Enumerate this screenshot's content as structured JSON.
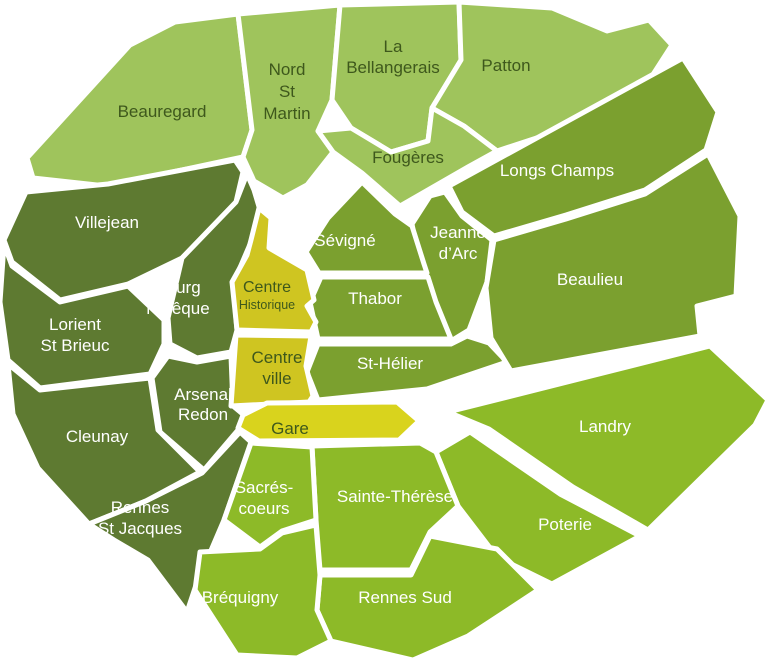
{
  "map": {
    "region_name": "Rennes",
    "background": "#ffffff",
    "palette": {
      "light": "#9fc45c",
      "medium": "#7ba02f",
      "dark": "#5e7a31",
      "bright": "#8dba28",
      "yellow_centre": "#cfc521",
      "yellow_gare": "#d9d31d",
      "boundary": "#ffffff",
      "label_dark": "#3e581c",
      "label_light": "#ffffff"
    },
    "districts": [
      {
        "id": "beauregard",
        "name": "Beauregard",
        "lines": [
          "Beauregard"
        ],
        "shade": "light",
        "label_tone": "dark",
        "points": "130,45 175,22 238,14 252,130 243,157 168,173 106,186 33,178 27,158",
        "label": {
          "x": 162,
          "y": 117,
          "size": 17,
          "line_height": 21
        }
      },
      {
        "id": "nord-st-martin",
        "name": "Nord St Martin",
        "lines": [
          "Nord",
          "St",
          "Martin"
        ],
        "shade": "light",
        "label_tone": "dark",
        "points": "238,14 340,5 332,100 318,131 333,152 307,185 283,198 254,181 243,157 252,130",
        "label": {
          "x": 287,
          "y": 75,
          "size": 17,
          "line_height": 22
        }
      },
      {
        "id": "la-bellangerais",
        "name": "La Bellangerais",
        "lines": [
          "La",
          "Bellangerais"
        ],
        "shade": "light",
        "label_tone": "dark",
        "points": "340,5 459,2 461,60 432,108 428,141 391,152 351,128 332,100",
        "label": {
          "x": 393,
          "y": 52,
          "size": 17,
          "line_height": 21
        }
      },
      {
        "id": "patton",
        "name": "Patton",
        "lines": [
          "Patton"
        ],
        "shade": "light",
        "label_tone": "dark",
        "points": "459,2 552,8 607,31 649,20 672,45 643,90 558,131 497,151 464,126 432,108 461,60",
        "label": {
          "x": 506,
          "y": 71,
          "size": 17,
          "line_height": 21
        }
      },
      {
        "id": "fougeres",
        "name": "Fougères",
        "lines": [
          "Fougères"
        ],
        "shade": "light",
        "label_tone": "dark",
        "points": "318,131 351,128 391,152 428,141 432,108 464,126 497,151 468,167 400,206 362,173 333,152",
        "label": {
          "x": 408,
          "y": 163,
          "size": 17,
          "line_height": 21
        }
      },
      {
        "id": "villejean",
        "name": "Villejean",
        "lines": [
          "Villejean"
        ],
        "shade": "dark",
        "label_tone": "light",
        "points": "26,192 108,184 235,160 243,172 236,202 182,258 128,284 60,300 12,262 4,240",
        "label": {
          "x": 107,
          "y": 228,
          "size": 17,
          "line_height": 21
        }
      },
      {
        "id": "bourg-leveque",
        "name": "Bourg l’évêque",
        "lines": [
          "Bourg",
          "l’évêque"
        ],
        "shade": "dark",
        "label_tone": "light",
        "points": "182,258 236,202 247,174 254,190 260,210 251,242 233,284 237,330 231,352 197,358 170,344 168,318",
        "label": {
          "x": 178,
          "y": 293,
          "size": 17,
          "line_height": 21
        }
      },
      {
        "id": "lorient-st-brieuc",
        "name": "Lorient St Brieuc",
        "lines": [
          "Lorient",
          "St Brieuc"
        ],
        "shade": "dark",
        "label_tone": "light",
        "points": "4,244 12,266 60,302 128,286 164,320 164,344 150,374 40,388 8,360 0,302",
        "label": {
          "x": 75,
          "y": 330,
          "size": 17,
          "line_height": 21
        }
      },
      {
        "id": "arsenal-redon",
        "name": "Arsenal Redon",
        "lines": [
          "Arsenal",
          "Redon"
        ],
        "shade": "dark",
        "label_tone": "light",
        "points": "152,378 168,356 197,362 231,356 233,406 245,416 238,430 204,470 160,432",
        "label": {
          "x": 203,
          "y": 400,
          "size": 17,
          "line_height": 20
        }
      },
      {
        "id": "cleunay",
        "name": "Cleunay",
        "lines": [
          "Cleunay"
        ],
        "shade": "dark",
        "label_tone": "light",
        "points": "8,364 40,390 150,378 158,430 200,472 146,501 89,524 38,468 13,414",
        "label": {
          "x": 97,
          "y": 442,
          "size": 17,
          "line_height": 21
        }
      },
      {
        "id": "rennes-st-jacques",
        "name": "Rennes St Jacques",
        "lines": [
          "Rennes",
          "St Jacques"
        ],
        "shade": "dark",
        "label_tone": "light",
        "points": "89,524 146,501 202,473 240,432 251,442 224,520 195,588 187,612 148,560 114,540",
        "label": {
          "x": 140,
          "y": 513,
          "size": 17,
          "line_height": 21
        }
      },
      {
        "id": "longs-champs",
        "name": "Longs Champs",
        "lines": [
          "Longs Champs"
        ],
        "shade": "medium",
        "label_tone": "light",
        "points": "449,186 683,58 718,112 706,150 645,190 566,215 494,236 462,212",
        "label": {
          "x": 557,
          "y": 176,
          "size": 17,
          "line_height": 21
        }
      },
      {
        "id": "jeanne-darc",
        "name": "Jeanne d’Arc",
        "lines": [
          "Jeanne",
          "d’Arc"
        ],
        "shade": "medium",
        "label_tone": "light",
        "points": "412,224 430,196 445,192 462,216 492,240 487,282 469,330 451,341 433,300 419,262",
        "label": {
          "x": 458,
          "y": 238,
          "size": 17,
          "line_height": 21
        }
      },
      {
        "id": "sevigne",
        "name": "Sévigné",
        "lines": [
          "Sévigné"
        ],
        "shade": "medium",
        "label_tone": "light",
        "points": "306,252 328,218 362,182 395,214 412,226 424,264 427,273 319,273",
        "label": {
          "x": 345,
          "y": 246,
          "size": 17,
          "line_height": 21
        }
      },
      {
        "id": "thabor",
        "name": "Thabor",
        "lines": [
          "Thabor"
        ],
        "shade": "medium",
        "label_tone": "light",
        "points": "321,277 428,277 436,302 451,339 318,339 310,302",
        "label": {
          "x": 375,
          "y": 304,
          "size": 17,
          "line_height": 21
        }
      },
      {
        "id": "st-helier",
        "name": "St-Hélier",
        "lines": [
          "St-Hélier"
        ],
        "shade": "medium",
        "label_tone": "light",
        "points": "318,344 451,344 467,336 489,343 507,362 427,389 318,400 307,372",
        "label": {
          "x": 390,
          "y": 369,
          "size": 17,
          "line_height": 21
        }
      },
      {
        "id": "beaulieu",
        "name": "Beaulieu",
        "lines": [
          "Beaulieu"
        ],
        "shade": "medium",
        "label_tone": "light",
        "points": "494,240 566,219 645,194 708,154 740,216 736,296 697,306 700,336 511,371 491,338 486,288",
        "label": {
          "x": 590,
          "y": 285,
          "size": 17,
          "line_height": 21
        }
      },
      {
        "id": "landry",
        "name": "Landry",
        "lines": [
          "Landry"
        ],
        "shade": "bright",
        "label_tone": "light",
        "points": "448,412 710,346 768,400 755,425 648,530 573,487 489,429",
        "label": {
          "x": 605,
          "y": 432,
          "size": 17,
          "line_height": 21
        }
      },
      {
        "id": "poterie",
        "name": "Poterie",
        "lines": [
          "Poterie"
        ],
        "shade": "bright",
        "label_tone": "light",
        "points": "436,452 470,432 560,494 640,536 552,584 497,557 458,506",
        "label": {
          "x": 565,
          "y": 530,
          "size": 17,
          "line_height": 21
        }
      },
      {
        "id": "sainte-therese",
        "name": "Sainte-Thérèse",
        "lines": [
          "Sainte-Thérèse"
        ],
        "shade": "bright",
        "label_tone": "light",
        "points": "312,446 420,443 436,452 458,506 430,532 411,570 320,570 316,520",
        "label": {
          "x": 395,
          "y": 502,
          "size": 17,
          "line_height": 21
        }
      },
      {
        "id": "sacres-coeurs",
        "name": "Sacrés-coeurs",
        "lines": [
          "Sacrés-",
          "coeurs"
        ],
        "shade": "bright",
        "label_tone": "light",
        "points": "251,443 312,447 316,520 282,531 260,547 224,520",
        "label": {
          "x": 264,
          "y": 493,
          "size": 17,
          "line_height": 21
        }
      },
      {
        "id": "rennes-sud",
        "name": "Rennes Sud",
        "lines": [
          "Rennes Sud"
        ],
        "shade": "bright",
        "label_tone": "light",
        "points": "320,575 411,575 430,536 497,549 538,590 468,636 413,660 331,641 317,610",
        "label": {
          "x": 405,
          "y": 603,
          "size": 17,
          "line_height": 21
        }
      },
      {
        "id": "brequigny",
        "name": "Bréquigny",
        "lines": [
          "Bréquigny"
        ],
        "shade": "bright",
        "label_tone": "light",
        "points": "200,552 260,549 282,533 316,525 320,575 317,610 331,641 297,658 237,655 195,590",
        "label": {
          "x": 240,
          "y": 603,
          "size": 17,
          "line_height": 21
        }
      },
      {
        "id": "centre-historique",
        "name": "Centre Historique",
        "lines": [
          "Centre",
          "Historique"
        ],
        "shade": "yellow_centre",
        "label_tone": "dark",
        "points": "259,208 271,218 269,248 307,270 314,300 307,306 316,322 311,332 237,330 232,282 247,255 251,240",
        "label": {
          "x": 267,
          "y": 292,
          "size": 16,
          "line_height": 17,
          "second_line_size": 12.5
        }
      },
      {
        "id": "centre-ville",
        "name": "Centre ville",
        "lines": [
          "Centre",
          "ville"
        ],
        "shade": "yellow_centre",
        "label_tone": "dark",
        "points": "236,335 311,336 306,366 313,396 309,402 231,406",
        "label": {
          "x": 277,
          "y": 363,
          "size": 17,
          "line_height": 21
        }
      },
      {
        "id": "gare",
        "name": "Gare",
        "lines": [
          "Gare"
        ],
        "shade": "yellow_gare",
        "label_tone": "dark",
        "points": "243,415 267,403 397,402 419,421 399,440 259,441 238,428",
        "label": {
          "x": 290,
          "y": 434,
          "size": 17,
          "line_height": 21
        }
      }
    ]
  }
}
